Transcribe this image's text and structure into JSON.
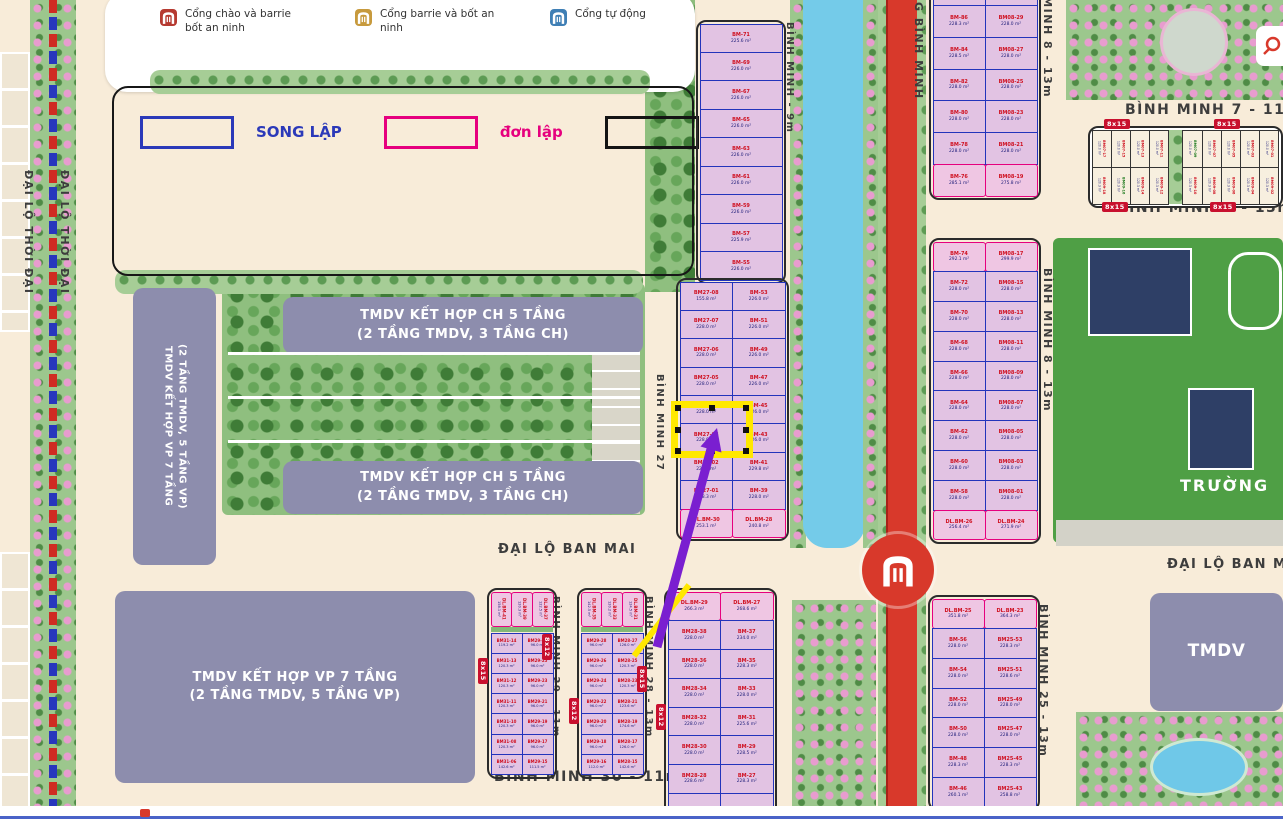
{
  "legend": {
    "gates": [
      {
        "key": "gate-red",
        "label": "Cổng chào và barrie bốt an ninh",
        "color": "#b63a31"
      },
      {
        "key": "gate-gold",
        "label": "Cổng barrie và bốt an ninh",
        "color": "#c79a3d"
      },
      {
        "key": "gate-blue",
        "label": "Cổng tự động",
        "color": "#3f7fb5"
      }
    ],
    "types": [
      {
        "label": "SONG LẬP",
        "color": "#2b39b9"
      },
      {
        "label": "đơn lập",
        "color": "#e6007e"
      },
      {
        "label": "liền kề",
        "color": "#141414"
      }
    ]
  },
  "street_labels": [
    {
      "key": "thoidai1",
      "text": "ĐẠI LỘ THỜI ĐẠI"
    },
    {
      "key": "thoidai2",
      "text": "ĐẠI LỘ THỜI ĐẠI"
    },
    {
      "key": "bm9m",
      "text": "BÌNH MINH - 9m"
    },
    {
      "key": "bm27",
      "text": "BÌNH MINH 27"
    },
    {
      "key": "gbm",
      "text": "G BÌNH MINH"
    },
    {
      "key": "bm8a",
      "text": "BÌNH MINH 8 - 13m"
    },
    {
      "key": "bm8b",
      "text": "BÌNH MINH 8 - 13m"
    },
    {
      "key": "bm7",
      "text": "BÌNH MINH 7 - 11m"
    },
    {
      "key": "bm9",
      "text": "BÌNH MINH 9 - 13m"
    },
    {
      "key": "banmai1",
      "text": "ĐẠI LỘ BAN MAI"
    },
    {
      "key": "banmai2",
      "text": "ĐẠI LỘ BAN MAI"
    },
    {
      "key": "bm29",
      "text": "BÌNH MINH 29 - 11m"
    },
    {
      "key": "bm28",
      "text": "BÌNH MINH 28 - 13m"
    },
    {
      "key": "bm30",
      "text": "BÌNH MINH 30 - 11m"
    },
    {
      "key": "bm25",
      "text": "BÌNH MINH 25 - 13m"
    }
  ],
  "buildings": [
    {
      "key": "vp-left",
      "lines": [
        "TMDV KẾT HỢP VP 7 TẦNG",
        "(2 TẦNG TMDV, 5 TẦNG VP)"
      ]
    },
    {
      "key": "ch-top",
      "lines": [
        "TMDV KẾT HỢP  CH 5 TẦNG",
        "(2 TẦNG TMDV, 3 TẦNG CH)"
      ]
    },
    {
      "key": "ch-bottom",
      "lines": [
        "TMDV KẾT HỢP  CH 5 TẦNG",
        "(2 TẦNG TMDV, 3 TẦNG CH)"
      ]
    },
    {
      "key": "vp-bottom",
      "lines": [
        "TMDV KẾT HỢP  VP 7 TẦNG",
        "(2 TẦNG TMDV, 5 TẦNG VP)"
      ]
    },
    {
      "key": "tmdv-right",
      "lines": [
        "TMDV"
      ]
    }
  ],
  "labels": {
    "school": "TRƯỜNG"
  },
  "selection": {
    "selected_lot": "BM27-03"
  },
  "lot_blocks": [
    {
      "key": "A",
      "columns": [
        [
          {
            "id": "BM-71",
            "area": "225.6 m²"
          },
          {
            "id": "BM-69",
            "area": "226.0 m²"
          },
          {
            "id": "BM-67",
            "area": "226.0 m²"
          },
          {
            "id": "BM-65",
            "area": "226.0 m²"
          },
          {
            "id": "BM-63",
            "area": "226.0 m²"
          },
          {
            "id": "BM-61",
            "area": "226.0 m²"
          },
          {
            "id": "BM-59",
            "area": "226.0 m²"
          },
          {
            "id": "BM-57",
            "area": "225.9 m²"
          },
          {
            "id": "BM-55",
            "area": "226.0 m²"
          }
        ]
      ]
    },
    {
      "key": "B",
      "columns": [
        [
          {
            "id": "BM27-08",
            "area": "155.8 m²"
          },
          {
            "id": "BM27-07",
            "area": "228.0 m²"
          },
          {
            "id": "BM27-06",
            "area": "228.0 m²"
          },
          {
            "id": "BM27-05",
            "area": "228.0 m²"
          },
          {
            "id": "BM27-04",
            "area": "228.0 m²"
          },
          {
            "id": "BM27-03",
            "area": "228.0 m²"
          },
          {
            "id": "BM27-02",
            "area": "228.0 m²"
          },
          {
            "id": "BM27-01",
            "area": "228.3 m²"
          },
          {
            "id": "DL.BM-30",
            "area": "253.1 m²",
            "t": "dl"
          }
        ],
        [
          {
            "id": "BM-53",
            "area": "226.0 m²"
          },
          {
            "id": "BM-51",
            "area": "226.0 m²"
          },
          {
            "id": "BM-49",
            "area": "226.0 m²"
          },
          {
            "id": "BM-47",
            "area": "226.0 m²"
          },
          {
            "id": "BM-45",
            "area": "226.0 m²"
          },
          {
            "id": "BM-43",
            "area": "226.0 m²"
          },
          {
            "id": "BM-41",
            "area": "229.8 m²"
          },
          {
            "id": "BM-39",
            "area": "228.0 m²"
          },
          {
            "id": "DL.BM-28",
            "area": "240.8 m²",
            "t": "dl"
          }
        ]
      ]
    },
    {
      "key": "C",
      "columns": [
        [
          {
            "id": "",
            "area": "228.0 m²"
          },
          {
            "id": "BM-86",
            "area": "228.3 m²"
          },
          {
            "id": "BM-84",
            "area": "228.5 m²"
          },
          {
            "id": "BM-82",
            "area": "228.0 m²"
          },
          {
            "id": "BM-80",
            "area": "228.0 m²"
          },
          {
            "id": "BM-78",
            "area": "228.0 m²"
          },
          {
            "id": "BM-76",
            "area": "285.1 m²",
            "t": "dl"
          }
        ],
        [
          {
            "id": "",
            "area": "228.0 m²"
          },
          {
            "id": "BM08-29",
            "area": "228.0 m²"
          },
          {
            "id": "BM08-27",
            "area": "228.0 m²"
          },
          {
            "id": "BM08-25",
            "area": "228.0 m²"
          },
          {
            "id": "BM08-23",
            "area": "228.0 m²"
          },
          {
            "id": "BM08-21",
            "area": "228.0 m²"
          },
          {
            "id": "BM08-19",
            "area": "275.8 m²",
            "t": "dl"
          }
        ]
      ]
    },
    {
      "key": "D",
      "columns": [
        [
          {
            "id": "BM-74",
            "area": "292.1 m²",
            "t": "dl"
          },
          {
            "id": "BM-72",
            "area": "228.0 m²"
          },
          {
            "id": "BM-70",
            "area": "228.0 m²"
          },
          {
            "id": "BM-68",
            "area": "228.0 m²"
          },
          {
            "id": "BM-66",
            "area": "228.0 m²"
          },
          {
            "id": "BM-64",
            "area": "228.0 m²"
          },
          {
            "id": "BM-62",
            "area": "228.0 m²"
          },
          {
            "id": "BM-60",
            "area": "228.0 m²"
          },
          {
            "id": "BM-58",
            "area": "228.0 m²"
          },
          {
            "id": "DL.BM-26",
            "area": "256.4 m²",
            "t": "dl"
          }
        ],
        [
          {
            "id": "BM08-17",
            "area": "299.9 m²",
            "t": "dl"
          },
          {
            "id": "BM08-15",
            "area": "228.0 m²"
          },
          {
            "id": "BM08-13",
            "area": "228.0 m²"
          },
          {
            "id": "BM08-11",
            "area": "228.0 m²"
          },
          {
            "id": "BM08-09",
            "area": "228.0 m²"
          },
          {
            "id": "BM08-07",
            "area": "228.0 m²"
          },
          {
            "id": "BM08-05",
            "area": "228.0 m²"
          },
          {
            "id": "BM08-03",
            "area": "228.0 m²"
          },
          {
            "id": "BM08-01",
            "area": "228.0 m²"
          },
          {
            "id": "DL.BM-24",
            "area": "271.9 m²",
            "t": "dl"
          }
        ]
      ]
    },
    {
      "key": "E",
      "header": [
        {
          "id": "DL.BM-41",
          "area": "158.1 m²",
          "t": "dl"
        },
        {
          "id": "DL.BM-39",
          "area": "120.3 m²",
          "t": "dl"
        },
        {
          "id": "DL.BM-37",
          "area": "122.5 m²",
          "t": "dl"
        }
      ],
      "columns": [
        [
          {
            "id": "BM31-14",
            "area": "119.2 m²"
          },
          {
            "id": "BM31-13",
            "area": "120.3 m²"
          },
          {
            "id": "BM31-12",
            "area": "120.3 m²"
          },
          {
            "id": "BM31-11",
            "area": "120.3 m²"
          },
          {
            "id": "BM31-10",
            "area": "120.3 m²"
          },
          {
            "id": "BM31-08",
            "area": "120.3 m²"
          },
          {
            "id": "BM31-06",
            "area": "142.6 m²"
          }
        ],
        [
          {
            "id": "BM29-27",
            "area": "96.0 m²"
          },
          {
            "id": "BM29-25",
            "area": "96.0 m²"
          },
          {
            "id": "BM29-23",
            "area": "96.0 m²"
          },
          {
            "id": "BM29-21",
            "area": "96.0 m²"
          },
          {
            "id": "BM29-19",
            "area": "96.0 m²"
          },
          {
            "id": "BM29-17",
            "area": "96.0 m²"
          },
          {
            "id": "BM29-15",
            "area": "111.5 m²"
          }
        ]
      ]
    },
    {
      "key": "F",
      "header": [
        {
          "id": "DL.BM-35",
          "area": "142.5 m²",
          "t": "dl"
        },
        {
          "id": "DL.BM-33",
          "area": "120.2 m²",
          "t": "dl"
        },
        {
          "id": "DL.BM-31",
          "area": "124.5 m²",
          "t": "dl"
        }
      ],
      "columns": [
        [
          {
            "id": "BM29-28",
            "area": "96.0 m²"
          },
          {
            "id": "BM29-26",
            "area": "96.0 m²"
          },
          {
            "id": "BM29-24",
            "area": "96.0 m²"
          },
          {
            "id": "BM29-22",
            "area": "96.0 m²"
          },
          {
            "id": "BM29-20",
            "area": "96.0 m²"
          },
          {
            "id": "BM29-18",
            "area": "96.0 m²"
          },
          {
            "id": "BM29-16",
            "area": "112.0 m²"
          }
        ],
        [
          {
            "id": "BM28-27",
            "area": "126.0 m²"
          },
          {
            "id": "BM28-25",
            "area": "120.3 m²"
          },
          {
            "id": "BM28-23",
            "area": "120.3 m²"
          },
          {
            "id": "BM28-21",
            "area": "123.6 m²"
          },
          {
            "id": "BM28-19",
            "area": "174.6 m²"
          },
          {
            "id": "BM28-17",
            "area": "126.0 m²"
          },
          {
            "id": "BM28-15",
            "area": "142.6 m²"
          }
        ]
      ]
    },
    {
      "key": "G",
      "columns": [
        [
          {
            "id": "DL.BM-29",
            "area": "266.3 m²",
            "t": "dl"
          },
          {
            "id": "BM28-38",
            "area": "228.0 m²"
          },
          {
            "id": "BM28-36",
            "area": "228.0 m²"
          },
          {
            "id": "BM28-34",
            "area": "228.0 m²"
          },
          {
            "id": "BM28-32",
            "area": "228.0 m²"
          },
          {
            "id": "BM28-30",
            "area": "228.0 m²"
          },
          {
            "id": "BM28-28",
            "area": "228.6 m²"
          },
          {
            "id": "",
            "area": ""
          }
        ],
        [
          {
            "id": "DL.BM-27",
            "area": "268.6 m²",
            "t": "dl"
          },
          {
            "id": "BM-37",
            "area": "234.0 m²"
          },
          {
            "id": "BM-35",
            "area": "228.3 m²"
          },
          {
            "id": "BM-33",
            "area": "228.0 m²"
          },
          {
            "id": "BM-31",
            "area": "225.6 m²"
          },
          {
            "id": "BM-29",
            "area": "228.5 m²"
          },
          {
            "id": "BM-27",
            "area": "228.3 m²"
          },
          {
            "id": "",
            "area": ""
          }
        ]
      ]
    },
    {
      "key": "H",
      "columns": [
        [
          {
            "id": "DL.BM-25",
            "area": "351.8 m²",
            "t": "dl"
          },
          {
            "id": "BM-56",
            "area": "228.0 m²"
          },
          {
            "id": "BM-54",
            "area": "228.0 m²"
          },
          {
            "id": "BM-52",
            "area": "228.0 m²"
          },
          {
            "id": "BM-50",
            "area": "228.0 m²"
          },
          {
            "id": "BM-48",
            "area": "228.3 m²"
          },
          {
            "id": "BM-46",
            "area": "260.1 m²"
          }
        ],
        [
          {
            "id": "DL.BM-23",
            "area": "364.3 m²",
            "t": "dl"
          },
          {
            "id": "BM25-53",
            "area": "228.3 m²"
          },
          {
            "id": "BM25-51",
            "area": "228.6 m²"
          },
          {
            "id": "BM25-49",
            "area": "228.0 m²"
          },
          {
            "id": "BM25-47",
            "area": "228.0 m²"
          },
          {
            "id": "BM25-45",
            "area": "228.3 m²"
          },
          {
            "id": "BM25-43",
            "area": "258.8 m²"
          }
        ]
      ]
    }
  ],
  "small_lot_rows": [
    {
      "left": [
        {
          "id": "BM07-17",
          "area": "120.0 m²"
        },
        {
          "id": "BM07-15",
          "area": "120.0 m²"
        },
        {
          "id": "BM07-13",
          "area": "120.0 m²"
        },
        {
          "id": "BM07-11",
          "area": "120.0 m²"
        }
      ],
      "right": [
        {
          "id": "BM07-09",
          "area": "120.0 m²",
          "t": "g"
        },
        {
          "id": "BM07-07",
          "area": "120.0 m²"
        },
        {
          "id": "BM07-05",
          "area": "120.0 m²"
        },
        {
          "id": "BM07-03",
          "area": "120.0 m²"
        },
        {
          "id": "BM07-01",
          "area": "120.0 m²"
        }
      ]
    },
    {
      "left": [
        {
          "id": "BM09-18",
          "area": "120.3 m²"
        },
        {
          "id": "BM09-16",
          "area": "120.3 m²",
          "t": "g"
        },
        {
          "id": "BM09-14",
          "area": "120.3 m²"
        },
        {
          "id": "BM09-12",
          "area": "120.3 m²"
        }
      ],
      "right": [
        {
          "id": "BM09-10",
          "area": "120.3 m²"
        },
        {
          "id": "BM09-08",
          "area": "120.3 m²"
        },
        {
          "id": "BM09-06",
          "area": "120.3 m²"
        },
        {
          "id": "BM09-04",
          "area": "120.3 m²"
        },
        {
          "id": "BM09-02",
          "area": "120.3 m²"
        }
      ]
    }
  ],
  "badges": [
    {
      "key": "b1",
      "text": "8x15"
    },
    {
      "key": "b2",
      "text": "8x12"
    },
    {
      "key": "b3",
      "text": "8x12"
    },
    {
      "key": "b4",
      "text": "8x15"
    },
    {
      "key": "b5",
      "text": "8x12"
    },
    {
      "key": "b6",
      "text": "8x15"
    },
    {
      "key": "b7",
      "text": "8x15"
    },
    {
      "key": "b8",
      "text": "8x15"
    },
    {
      "key": "b9",
      "text": "8x15"
    }
  ],
  "colors": {
    "song_lap": "#2b39b9",
    "don_lap": "#e6007e",
    "lien_ke": "#141414",
    "highlight": "#ffe800",
    "arrow": "#7a1fd0",
    "road": "#d8392b",
    "river": "#74cbe9"
  }
}
